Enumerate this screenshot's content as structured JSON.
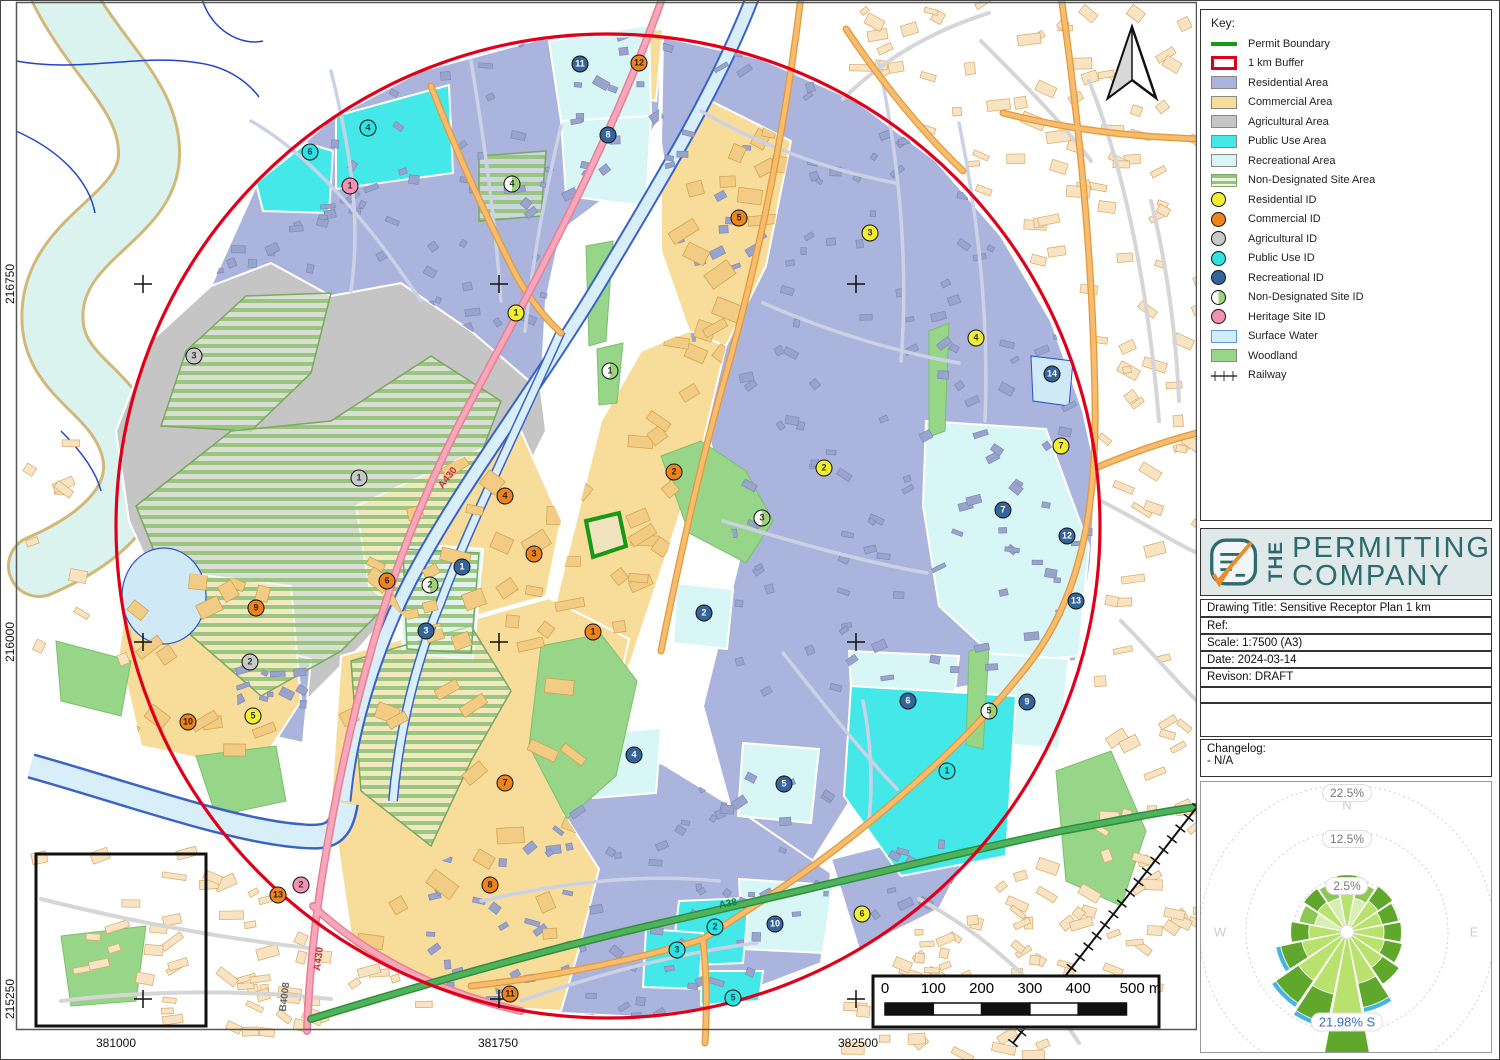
{
  "legend": {
    "title": "Key:",
    "items": [
      {
        "label": "Permit Boundary",
        "type": "line",
        "color": "#169a16"
      },
      {
        "label": "1 km Buffer",
        "type": "rect-outline",
        "color": "#e0001a"
      },
      {
        "label": "Residential Area",
        "type": "fill",
        "color": "#aab4dc"
      },
      {
        "label": "Commercial Area",
        "type": "fill",
        "color": "#f8dc9a"
      },
      {
        "label": "Agricultural Area",
        "type": "fill",
        "color": "#c5c5c5"
      },
      {
        "label": "Public Use Area",
        "type": "fill",
        "color": "#45e8e8"
      },
      {
        "label": "Recreational Area",
        "type": "fill",
        "color": "#d9f6f6"
      },
      {
        "label": "Non-Designated Site Area",
        "type": "stripes",
        "color": "#93c478"
      },
      {
        "label": "Residential ID",
        "type": "circle",
        "color": "#f2ee30"
      },
      {
        "label": "Commercial ID",
        "type": "circle",
        "color": "#f0841c"
      },
      {
        "label": "Agricultural ID",
        "type": "circle",
        "color": "#c9c9c9"
      },
      {
        "label": "Public Use ID",
        "type": "circle",
        "color": "#2ee2e2"
      },
      {
        "label": "Recreational ID",
        "type": "circle",
        "color": "#33649c"
      },
      {
        "label": "Non-Designated Site ID",
        "type": "circle-half",
        "color": "#9ed17c"
      },
      {
        "label": "Heritage Site ID",
        "type": "circle",
        "color": "#f490b2"
      },
      {
        "label": "Surface Water",
        "type": "fill-border",
        "color": "#d4ecf7",
        "border": "#5b9bd5"
      },
      {
        "label": "Woodland",
        "type": "fill",
        "color": "#97d588"
      },
      {
        "label": "Railway",
        "type": "railway",
        "color": "#333333"
      }
    ]
  },
  "logo": {
    "prefix": "THE",
    "line1": "PERMITTING",
    "line2": "COMPANY"
  },
  "title_block": {
    "rows": [
      "Drawing Title: Sensitive Receptor Plan 1 km",
      "Ref:",
      "Scale: 1:7500 (A3)",
      "Date:   2024-03-14",
      "Revison: DRAFT"
    ],
    "changelog": {
      "line1": "Changelog:",
      "line2": "- N/A"
    }
  },
  "map": {
    "coordinate_labels": {
      "left": [
        {
          "text": "216750",
          "y": 283
        },
        {
          "text": "216000",
          "y": 641
        },
        {
          "text": "215250",
          "y": 998
        }
      ],
      "bottom": [
        {
          "text": "381000",
          "x": 115
        },
        {
          "text": "381750",
          "x": 497
        },
        {
          "text": "382500",
          "x": 857
        }
      ]
    },
    "road_labels": [
      {
        "text": "A430",
        "x": 447,
        "y": 477,
        "rot": -52,
        "color": "#c03048"
      },
      {
        "text": "A430",
        "x": 318,
        "y": 958,
        "rot": -83,
        "color": "#c03048"
      },
      {
        "text": "A38",
        "x": 727,
        "y": 903,
        "rot": -11,
        "color": "#1d7a2e"
      },
      {
        "text": "B4008",
        "x": 284,
        "y": 996,
        "rot": -83,
        "color": "#666666"
      }
    ],
    "scale_bar": {
      "labels": [
        "0",
        "100",
        "200",
        "300",
        "400",
        "500 m"
      ]
    },
    "marker_styles": {
      "residential": {
        "bg": "#f2ee30",
        "fg": "#333333"
      },
      "commercial": {
        "bg": "#f0841c",
        "fg": "#222222"
      },
      "agricultural": {
        "bg": "#c9c9c9",
        "fg": "#333333"
      },
      "public_use": {
        "bg": "#2ee2e2",
        "fg": "#05445e"
      },
      "recreational": {
        "bg": "#33649c",
        "fg": "#ffffff"
      },
      "non_designated": {
        "bg": "half",
        "fg": "#333333"
      },
      "heritage": {
        "bg": "#f490b2",
        "fg": "#333333"
      }
    },
    "markers": {
      "residential": [
        {
          "id": "1",
          "x": 515,
          "y": 312
        },
        {
          "id": "2",
          "x": 823,
          "y": 467
        },
        {
          "id": "3",
          "x": 869,
          "y": 232
        },
        {
          "id": "4",
          "x": 975,
          "y": 337
        },
        {
          "id": "5",
          "x": 252,
          "y": 715
        },
        {
          "id": "6",
          "x": 861,
          "y": 913
        },
        {
          "id": "7",
          "x": 1060,
          "y": 445
        }
      ],
      "commercial": [
        {
          "id": "1",
          "x": 592,
          "y": 631
        },
        {
          "id": "2",
          "x": 673,
          "y": 471
        },
        {
          "id": "3",
          "x": 533,
          "y": 553
        },
        {
          "id": "4",
          "x": 504,
          "y": 495
        },
        {
          "id": "5",
          "x": 738,
          "y": 217
        },
        {
          "id": "6",
          "x": 386,
          "y": 580
        },
        {
          "id": "7",
          "x": 504,
          "y": 782
        },
        {
          "id": "8",
          "x": 489,
          "y": 884
        },
        {
          "id": "9",
          "x": 255,
          "y": 607
        },
        {
          "id": "10",
          "x": 187,
          "y": 721
        },
        {
          "id": "11",
          "x": 509,
          "y": 993
        },
        {
          "id": "12",
          "x": 638,
          "y": 62
        },
        {
          "id": "13",
          "x": 277,
          "y": 894
        }
      ],
      "agricultural": [
        {
          "id": "1",
          "x": 358,
          "y": 477
        },
        {
          "id": "2",
          "x": 249,
          "y": 661
        },
        {
          "id": "3",
          "x": 193,
          "y": 355
        }
      ],
      "public_use": [
        {
          "id": "1",
          "x": 946,
          "y": 770
        },
        {
          "id": "2",
          "x": 714,
          "y": 926
        },
        {
          "id": "3",
          "x": 676,
          "y": 949
        },
        {
          "id": "4",
          "x": 367,
          "y": 127
        },
        {
          "id": "5",
          "x": 732,
          "y": 997
        },
        {
          "id": "6",
          "x": 309,
          "y": 151
        }
      ],
      "recreational": [
        {
          "id": "1",
          "x": 461,
          "y": 566
        },
        {
          "id": "2",
          "x": 703,
          "y": 612
        },
        {
          "id": "3",
          "x": 425,
          "y": 630
        },
        {
          "id": "4",
          "x": 633,
          "y": 754
        },
        {
          "id": "5",
          "x": 783,
          "y": 783
        },
        {
          "id": "6",
          "x": 907,
          "y": 700
        },
        {
          "id": "7",
          "x": 1002,
          "y": 509
        },
        {
          "id": "8",
          "x": 607,
          "y": 134
        },
        {
          "id": "9",
          "x": 1026,
          "y": 701
        },
        {
          "id": "10",
          "x": 774,
          "y": 923
        },
        {
          "id": "11",
          "x": 579,
          "y": 63
        },
        {
          "id": "12",
          "x": 1066,
          "y": 535
        },
        {
          "id": "13",
          "x": 1075,
          "y": 600
        },
        {
          "id": "14",
          "x": 1051,
          "y": 373
        }
      ],
      "non_designated": [
        {
          "id": "1",
          "x": 609,
          "y": 370
        },
        {
          "id": "2",
          "x": 429,
          "y": 584
        },
        {
          "id": "3",
          "x": 761,
          "y": 517
        },
        {
          "id": "4",
          "x": 511,
          "y": 183
        },
        {
          "id": "5",
          "x": 988,
          "y": 710
        }
      ],
      "heritage": [
        {
          "id": "1",
          "x": 349,
          "y": 185
        },
        {
          "id": "2",
          "x": 300,
          "y": 884
        }
      ]
    }
  },
  "wind_rose": {
    "ring_labels": [
      "2.5%",
      "12.5%",
      "22.5%"
    ],
    "compass": [
      "N",
      "E",
      "W"
    ],
    "annotation": "21.98% S",
    "directions": [
      "N",
      "NNE",
      "NE",
      "ENE",
      "E",
      "ESE",
      "SE",
      "SSE",
      "S",
      "SSW",
      "SW",
      "WSW",
      "W",
      "WNW",
      "NW",
      "NNW"
    ],
    "values": [
      3.2,
      1.8,
      2.8,
      2.2,
      2.6,
      3.0,
      4.5,
      7.5,
      21.98,
      11.0,
      9.5,
      5.5,
      3.0,
      1.4,
      2.2,
      1.8
    ]
  }
}
